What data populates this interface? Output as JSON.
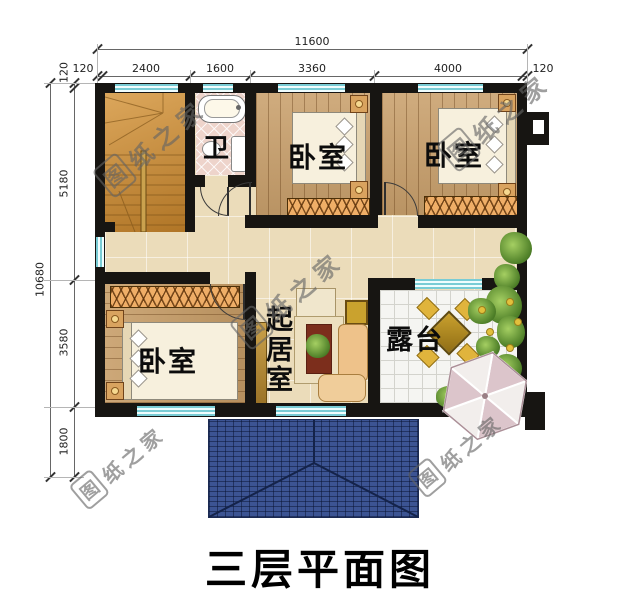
{
  "title": {
    "text": "三层平面图"
  },
  "watermark": {
    "logo": "图",
    "rest": "纸之家"
  },
  "dims": {
    "top": {
      "overall": "11600",
      "seg": [
        "120",
        "2400",
        "1600",
        "3360",
        "4000",
        "120"
      ]
    },
    "left": {
      "overall": "10680",
      "seg": [
        "120",
        "5180",
        "3580",
        "1800"
      ]
    }
  },
  "rooms": {
    "bath": "卫",
    "bedroom": "卧室",
    "living": "起居室",
    "terrace": "露台"
  },
  "colors": {
    "wall": "#171512",
    "window_cyan": "#79ccd5",
    "roof_blue": "#3c5493",
    "wood_floor": "#c9a06c",
    "tile_beige": "#ebdcba",
    "bath_pink": "#eed4cb",
    "wardrobe_orange": "#efae67",
    "watermark_gray": "#696969"
  }
}
